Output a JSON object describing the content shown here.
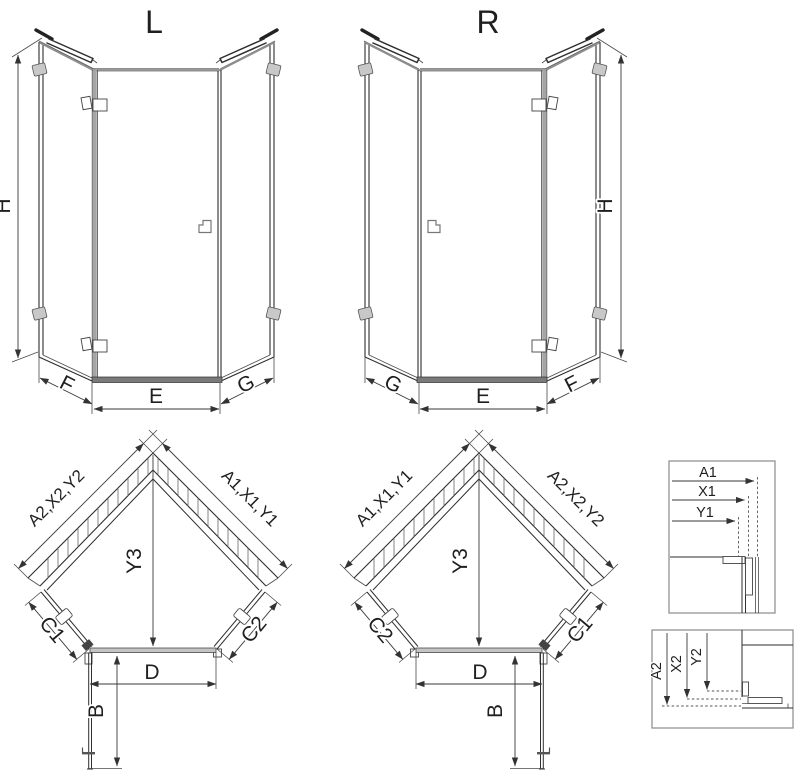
{
  "views": {
    "elevation_left": {
      "label": "L",
      "dim_height": "H",
      "dim_left": "F",
      "dim_bottom": "E",
      "dim_right": "G"
    },
    "elevation_right": {
      "label": "R",
      "dim_height": "H",
      "dim_left": "G",
      "dim_bottom": "E",
      "dim_right": "F"
    },
    "plan_left": {
      "dim_wall_left": "A2,X2,Y2",
      "dim_wall_right": "A1,X1,Y1",
      "dim_center": "Y3",
      "dim_side_left": "C1",
      "dim_side_right": "C2",
      "dim_width": "D",
      "dim_door": "B"
    },
    "plan_right": {
      "dim_wall_left": "A1,X1,Y1",
      "dim_wall_right": "A2,X2,Y2",
      "dim_center": "Y3",
      "dim_side_left": "C2",
      "dim_side_right": "C1",
      "dim_width": "D",
      "dim_door": "B"
    },
    "detail_top": {
      "labels": [
        "A1",
        "X1",
        "Y1"
      ]
    },
    "detail_bottom": {
      "labels": [
        "A2",
        "X2",
        "Y2"
      ]
    }
  },
  "colors": {
    "background": "#ffffff",
    "line": "#2e2e2e",
    "dimension_line": "#3a3a3a",
    "profile_gray": "#8f8f8f",
    "clamp_fill": "#c8c8c8",
    "sill_fill": "#7a7a7a"
  }
}
